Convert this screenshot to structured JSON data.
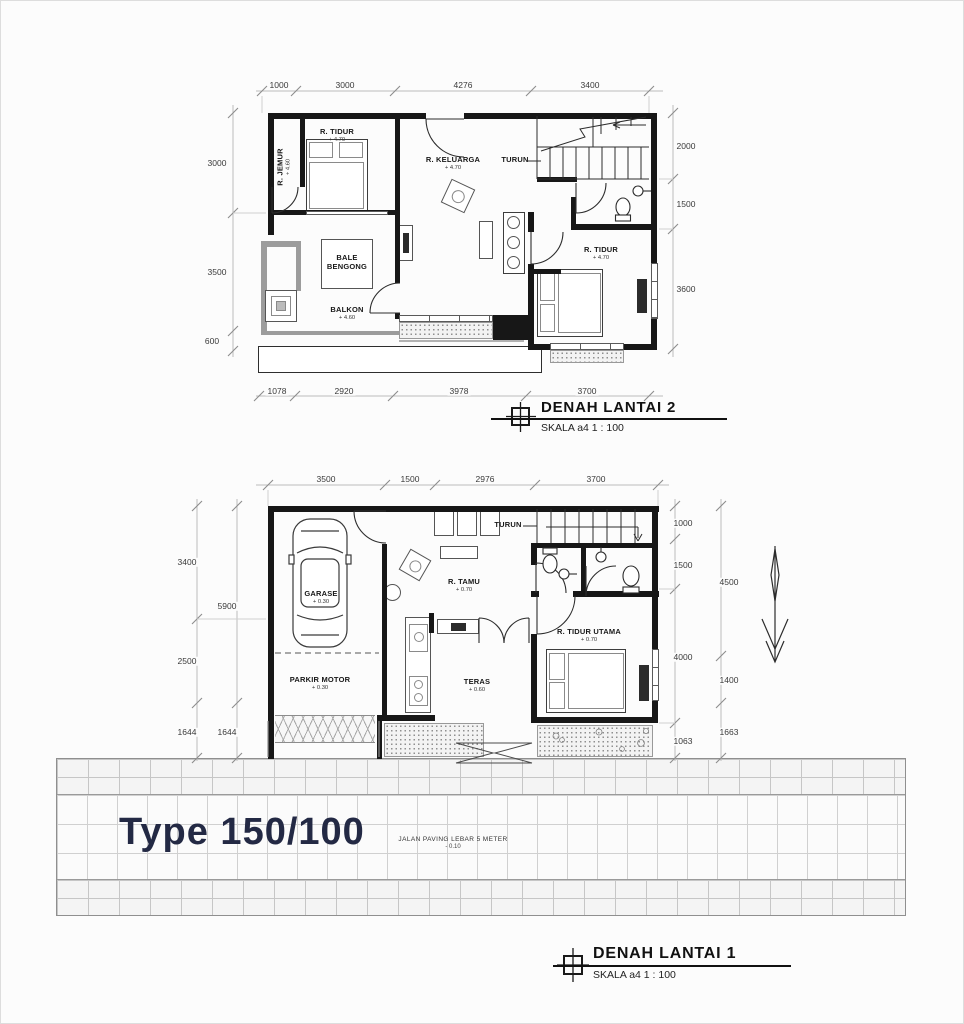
{
  "sheet": {
    "type_label": "Type 150/100"
  },
  "road": {
    "label": "JALAN PAVING LEBAR 5 METER",
    "level": "- 0.10"
  },
  "plan2": {
    "title": "DENAH LANTAI 2",
    "scale": "SKALA a4 1 : 100",
    "dims": {
      "top": [
        "1000",
        "3000",
        "4276",
        "3400"
      ],
      "left": [
        "3000",
        "3500",
        "600"
      ],
      "right": [
        "2000",
        "1500",
        "3600"
      ],
      "bottom": [
        "1078",
        "2920",
        "3978",
        "3700"
      ]
    },
    "rooms": {
      "r_tidur_1": {
        "name": "R. TIDUR",
        "level": "+ 4.70"
      },
      "r_jemur": {
        "name": "R. JEMUR",
        "level": "+ 4.60"
      },
      "r_keluarga": {
        "name": "R. KELUARGA",
        "level": "+ 4.70"
      },
      "r_tidur_2": {
        "name": "R. TIDUR",
        "level": "+ 4.70"
      },
      "bale_bengong": {
        "name": "BALE BENGONG"
      },
      "balkon": {
        "name": "BALKON",
        "level": "+ 4.60"
      },
      "turun": {
        "name": "TURUN"
      }
    }
  },
  "plan1": {
    "title": "DENAH LANTAI 1",
    "scale": "SKALA a4 1 : 100",
    "dims": {
      "top": [
        "3500",
        "1500",
        "2976",
        "3700"
      ],
      "left_outer": [
        "3400",
        "2500",
        "1644"
      ],
      "left_inner": [
        "5900",
        "1644"
      ],
      "right_inner": [
        "1000",
        "1500",
        "4000",
        "1063"
      ],
      "right_outer": [
        "4500",
        "1400",
        "1663"
      ]
    },
    "rooms": {
      "garase": {
        "name": "GARASE",
        "level": "+ 0.30"
      },
      "parkir_motor": {
        "name": "PARKIR MOTOR",
        "level": "+ 0.30"
      },
      "r_tamu": {
        "name": "R. TAMU",
        "level": "+ 0.70"
      },
      "r_tidur_utama": {
        "name": "R. TIDUR UTAMA",
        "level": "+ 0.70"
      },
      "teras": {
        "name": "TERAS",
        "level": "+ 0.60"
      },
      "turun": {
        "name": "TURUN"
      }
    }
  }
}
